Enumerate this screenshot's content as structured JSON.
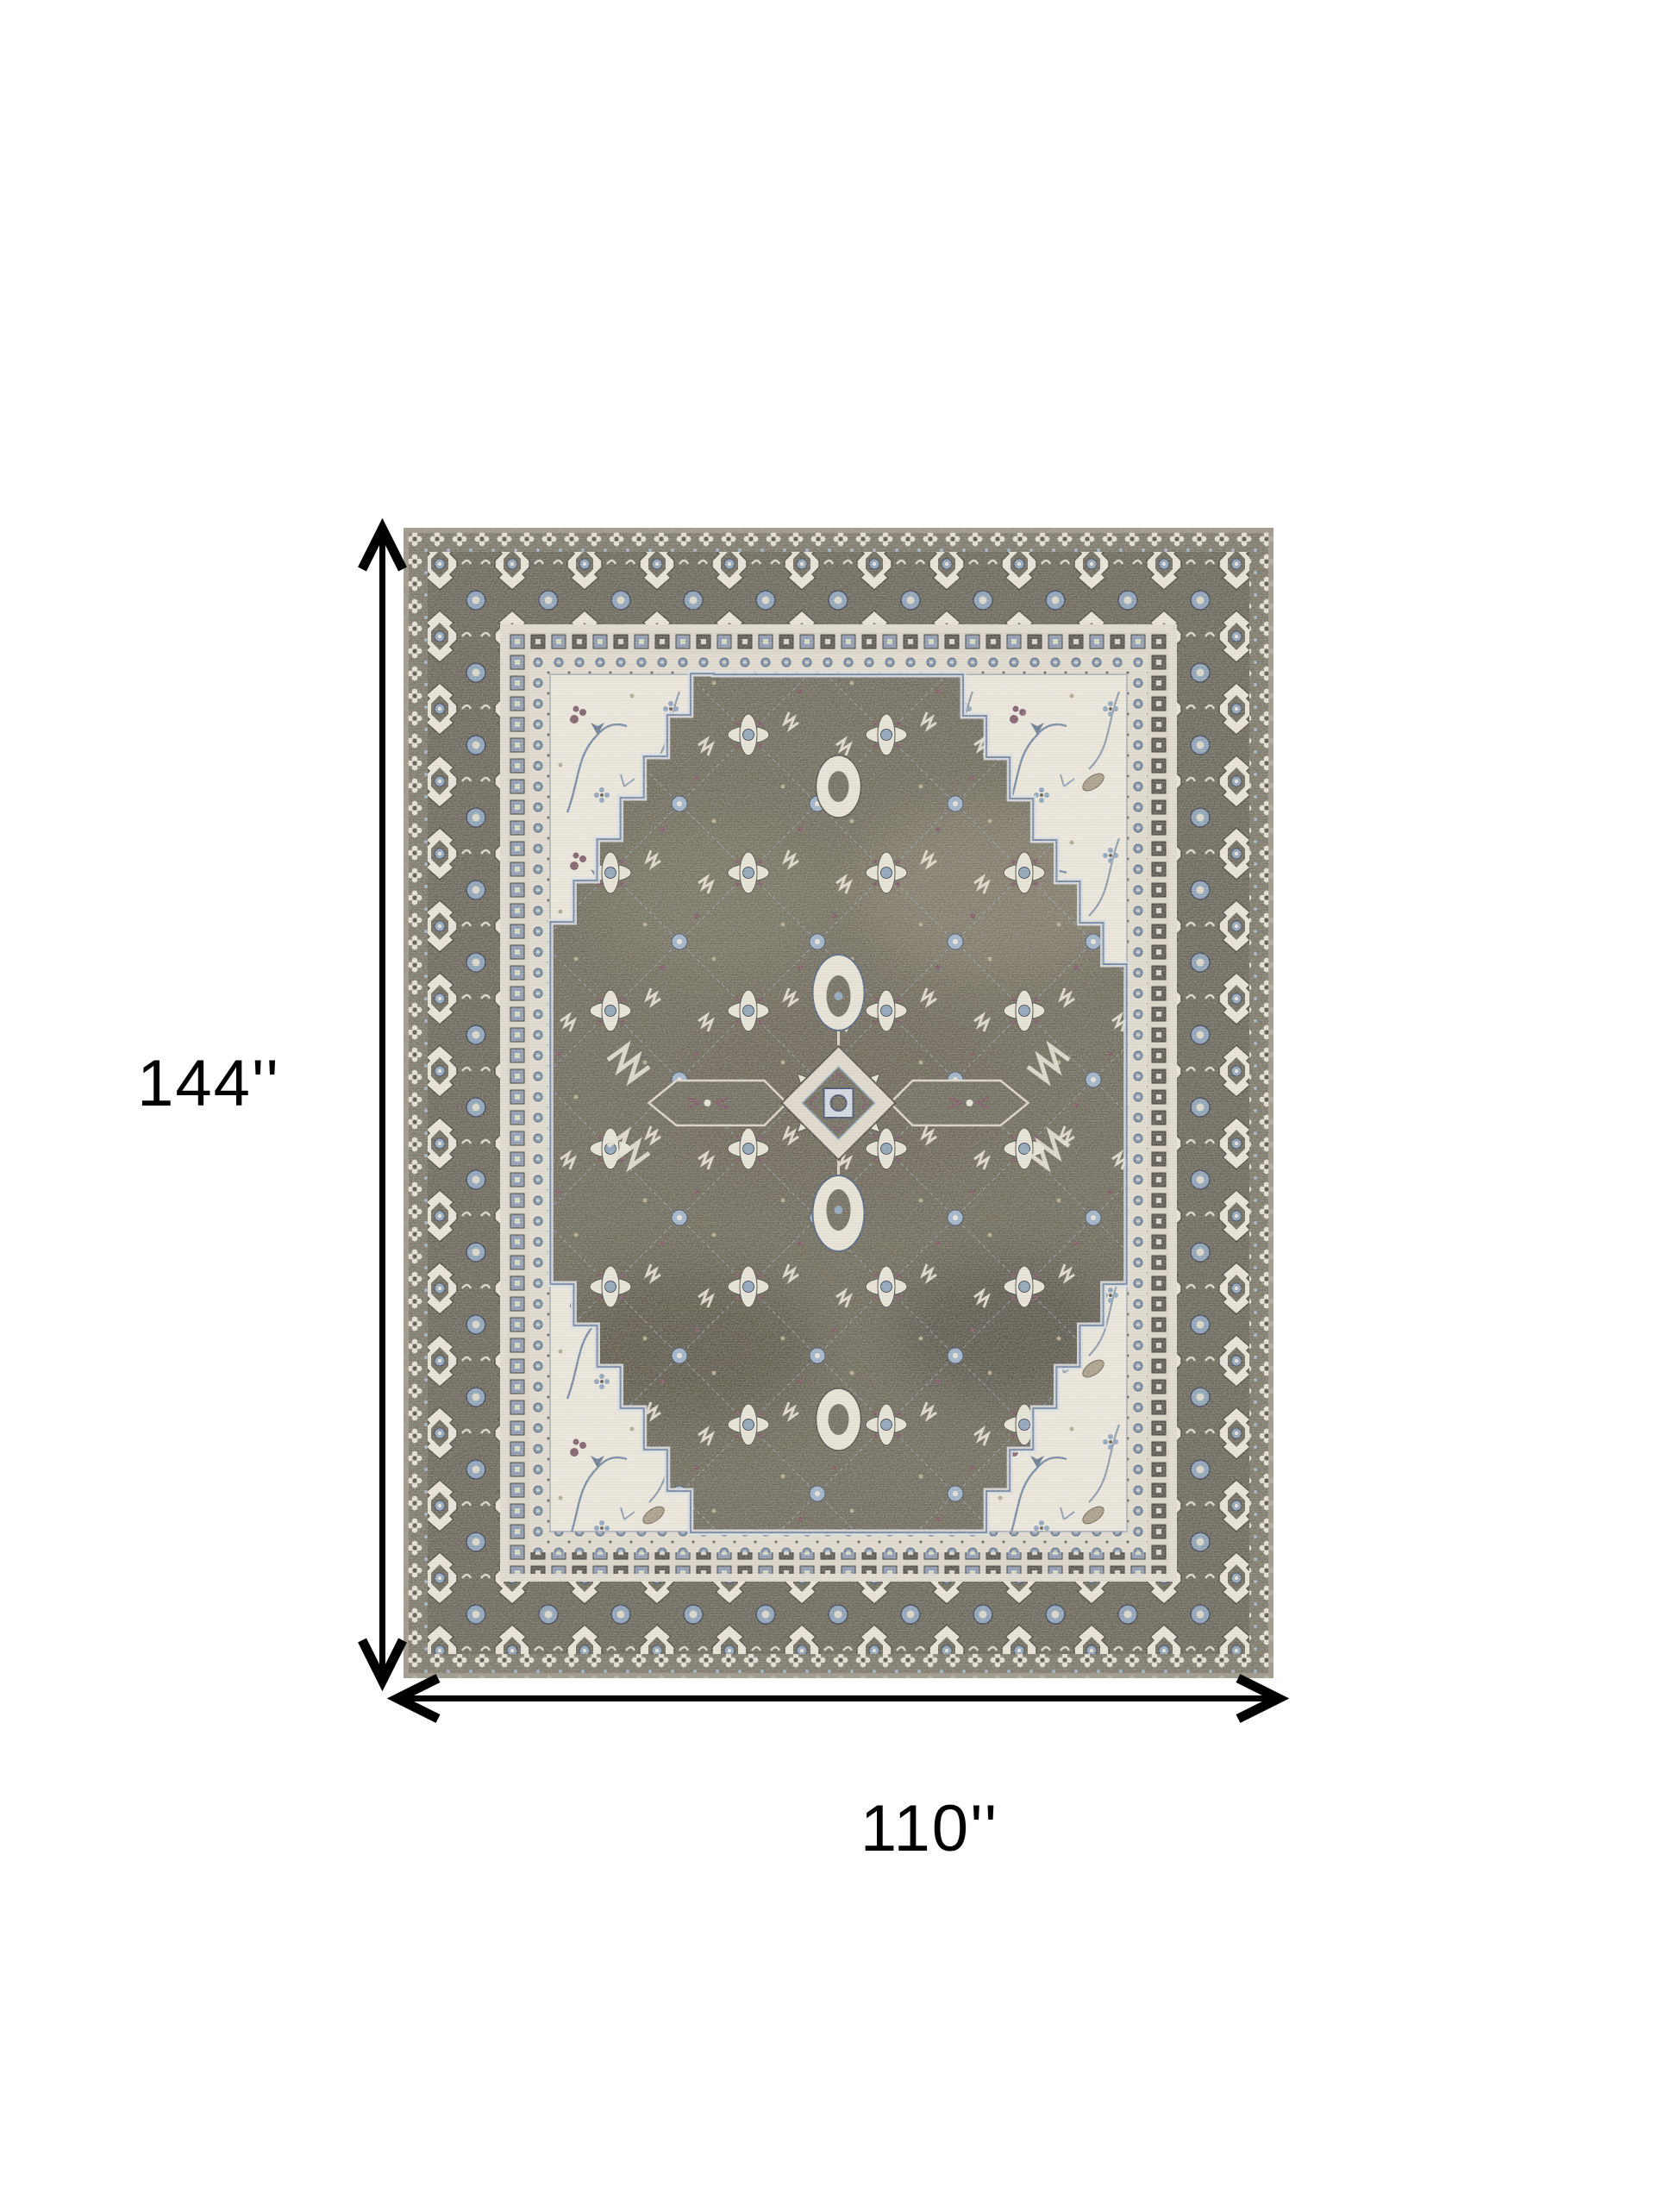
{
  "page": {
    "background_color": "#ffffff"
  },
  "annotations": {
    "height_label": "144''",
    "width_label": "110''",
    "arrow_color": "#000000"
  },
  "rug": {
    "alt": "Gray taupe and ivory distressed traditional medallion area rug",
    "colors": {
      "edge": "#a9a496",
      "guard_ground": "#7b7769",
      "border_ground": "#6b675b",
      "ivory_stripe": "#ded9cc",
      "panel_ivory": "#e9e5da",
      "field_ground": "#6f6b5d",
      "motif_ivory": "#e7e2d5",
      "motif_blue": "#8da2b8",
      "motif_plum": "#7a5864",
      "outline_dark": "#4e4a43"
    }
  }
}
